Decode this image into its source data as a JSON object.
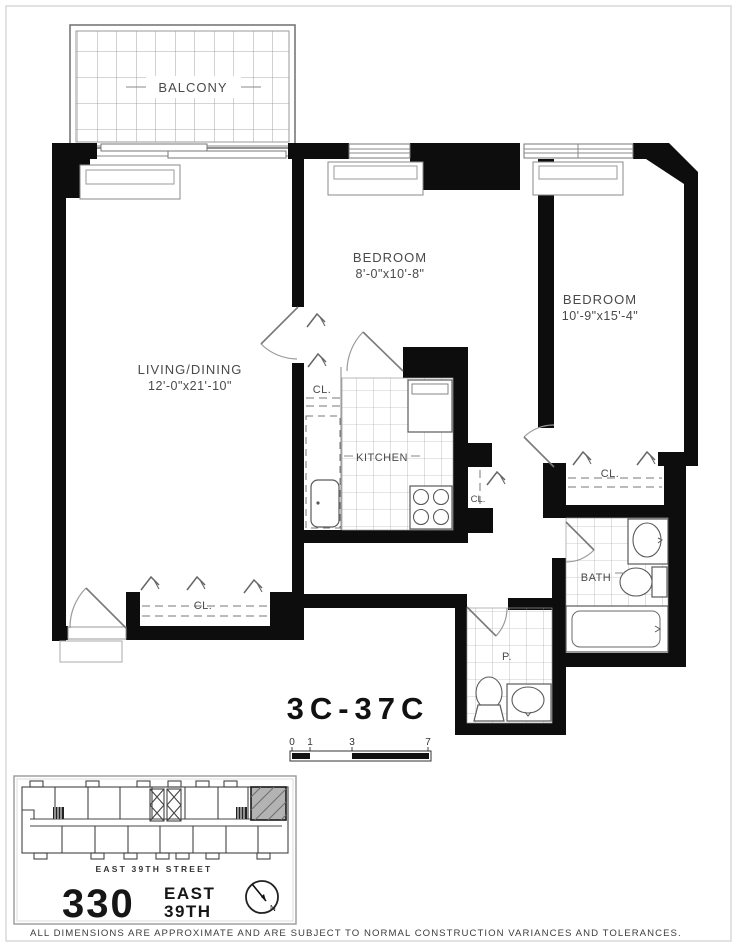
{
  "title_block": {
    "unit_label": "3C-37C"
  },
  "rooms": {
    "balcony": "BALCONY",
    "living_label": "LIVING/DINING",
    "living_dims": "12'-0\"x21'-10\"",
    "bedroom1_label": "BEDROOM",
    "bedroom1_dims": "8'-0\"x10'-8\"",
    "bedroom2_label": "BEDROOM",
    "bedroom2_dims": "10'-9\"x15'-4\"",
    "kitchen": "KITCHEN",
    "bath": "BATH",
    "powder": "P.",
    "closet": "CL."
  },
  "scale_bar": {
    "ticks": [
      "0",
      "1",
      "3",
      "7"
    ]
  },
  "key_plan": {
    "street_label": "EAST 39TH STREET"
  },
  "logo": {
    "number": "330",
    "word1": "EAST",
    "word2": "39TH",
    "north": "N"
  },
  "footer": {
    "disclaimer": "ALL DIMENSIONS ARE APPROXIMATE AND ARE SUBJECT TO NORMAL CONSTRUCTION VARIANCES AND TOLERANCES."
  }
}
